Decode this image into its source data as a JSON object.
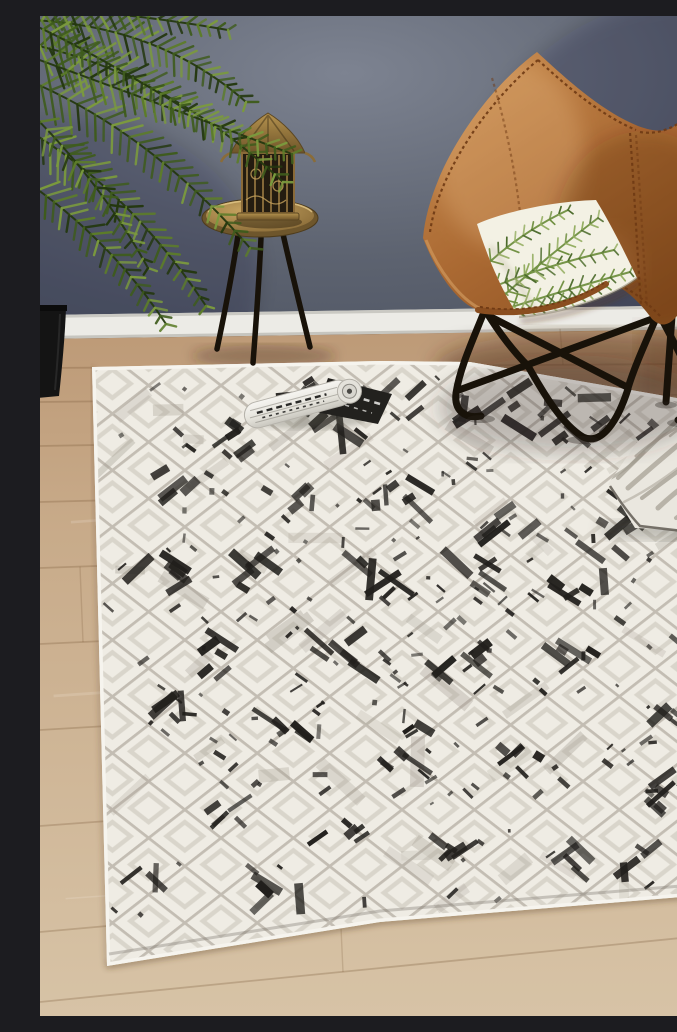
{
  "image_alt": "Room scene photo: a distressed ivory, grey and black diamond-lattice rug lies on light oak floorboards against a dark blue-grey wall with white skirting. A tan leather butterfly chair with a black metal frame holds a green palm-print cushion. Beside it stand a black tripod side table with a brass lantern and a potted palm plant. A rolled magazine and a grey zebra-textured cushion rest on the rug.",
  "scene": {
    "objects": [
      {
        "name": "wall",
        "label": "dark blue-grey painted wall"
      },
      {
        "name": "skirting-board",
        "label": "white skirting board"
      },
      {
        "name": "timber-floor",
        "label": "light oak floorboards"
      },
      {
        "name": "rug",
        "label": "ivory rug with grey diamond lattice and black distressed marks"
      },
      {
        "name": "butterfly-chair",
        "label": "tan leather butterfly chair with black frame"
      },
      {
        "name": "palm-cushion",
        "label": "white cushion with green palm-leaf print"
      },
      {
        "name": "side-table",
        "label": "black tripod side table with brass tray top"
      },
      {
        "name": "brass-lantern",
        "label": "brass cage lantern"
      },
      {
        "name": "palm-plant",
        "label": "potted palm plant"
      },
      {
        "name": "planter-pot",
        "label": "black planter pot"
      },
      {
        "name": "rolled-magazine",
        "label": "rolled black and white magazine"
      },
      {
        "name": "zebra-cushion",
        "label": "grey zebra-stripe cushion"
      }
    ],
    "palette": {
      "wall_light": "#7d8391",
      "wall_dark": "#4b5160",
      "baseboard": "#ecebe6",
      "baseboard_shadow": "#c2c0ba",
      "floor_light": "#d7c3a6",
      "floor_mid": "#c8ab8a",
      "floor_dark": "#a57c52",
      "plank_line": "#7a5838",
      "rug_base": "#efece4",
      "lattice": "#b8b2a6",
      "lattice_light": "#d8d4c9",
      "distress": "#211f1c",
      "distress_grey": "#a39d92",
      "leather": "#b06f3a",
      "leather_light": "#cb9257",
      "leather_dark": "#8a4e20",
      "stitch": "#6f3a14",
      "frame": "#181209",
      "cushion": "#f3f1e4",
      "palm_dark": "#4c6b2c",
      "palm_mid": "#6f8f40",
      "palm_light": "#93ad60",
      "plant_dark": "#24380f",
      "plant_mid": "#3f5c1d",
      "plant_light": "#5d7d2a",
      "plant_highlight": "#7b9a3e",
      "pot": "#141414",
      "brass_light": "#caa763",
      "brass": "#8a6c38",
      "brass_dark": "#5c4722",
      "zebra_base": "#eae7df",
      "zebra_stripe": "#a29c90",
      "mag_white": "#f2f1ec",
      "mag_dark": "#22211e"
    }
  }
}
